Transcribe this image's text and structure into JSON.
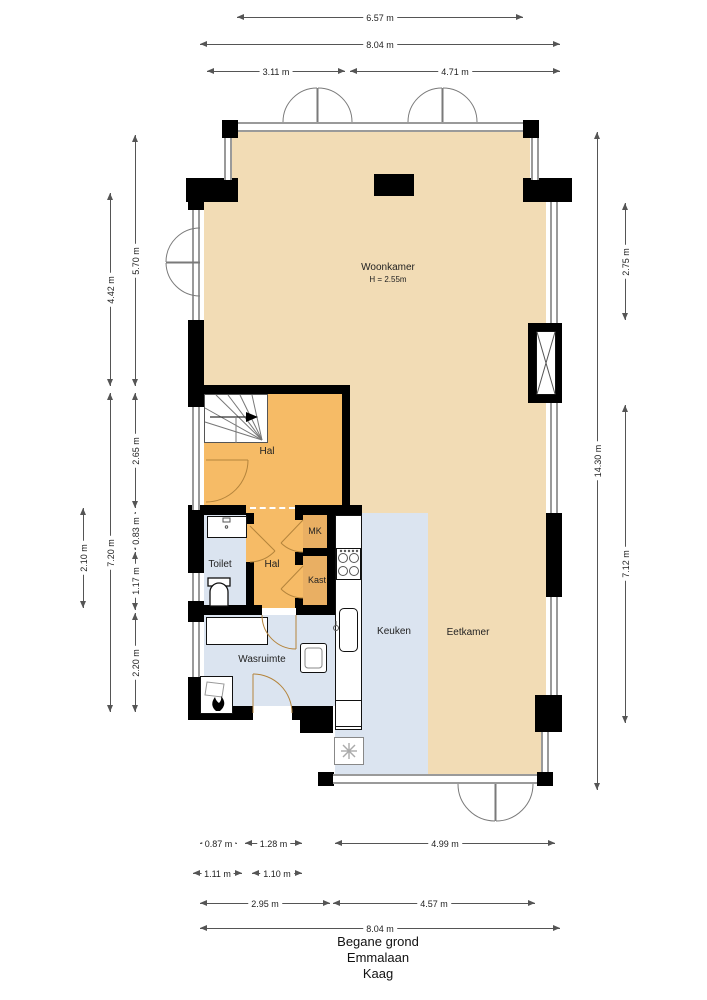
{
  "plan": {
    "rooms": {
      "woonkamer": {
        "label": "Woonkamer",
        "height": "H = 2.55m"
      },
      "hal": {
        "label": "Hal"
      },
      "hal2": {
        "label": "Hal"
      },
      "toilet": {
        "label": "Toilet"
      },
      "mk": {
        "label": "MK"
      },
      "kast": {
        "label": "Kast"
      },
      "keuken": {
        "label": "Keuken"
      },
      "eetkamer": {
        "label": "Eetkamer"
      },
      "wasruimte": {
        "label": "Wasruimte"
      }
    },
    "colors": {
      "living": "#f2dcb5",
      "hall": "#f6bb66",
      "closet": "#e9af63",
      "wet": "#dbe4f0",
      "wall": "#000000",
      "window": "#9a9a9a"
    }
  },
  "dimensions": {
    "top": {
      "d657": "6.57 m",
      "d804": "8.04 m",
      "d311": "3.11 m",
      "d471": "4.71 m"
    },
    "left": {
      "d570": "5.70 m",
      "d442": "4.42 m",
      "d265": "2.65 m",
      "d083": "0.83 m",
      "d210": "2.10 m",
      "d720": "7.20 m",
      "d117": "1.17 m",
      "d220": "2.20 m"
    },
    "right": {
      "d1430": "14.30 m",
      "d275": "2.75 m",
      "d712": "7.12 m"
    },
    "bottom": {
      "d087": "0.87 m",
      "d128": "1.28 m",
      "d499": "4.99 m",
      "d111": "1.11 m",
      "d110": "1.10 m",
      "d295": "2.95 m",
      "d457": "4.57 m",
      "d804": "8.04 m"
    }
  },
  "footer": {
    "line1": "Begane grond",
    "line2": "Emmalaan",
    "line3": "Kaag"
  }
}
